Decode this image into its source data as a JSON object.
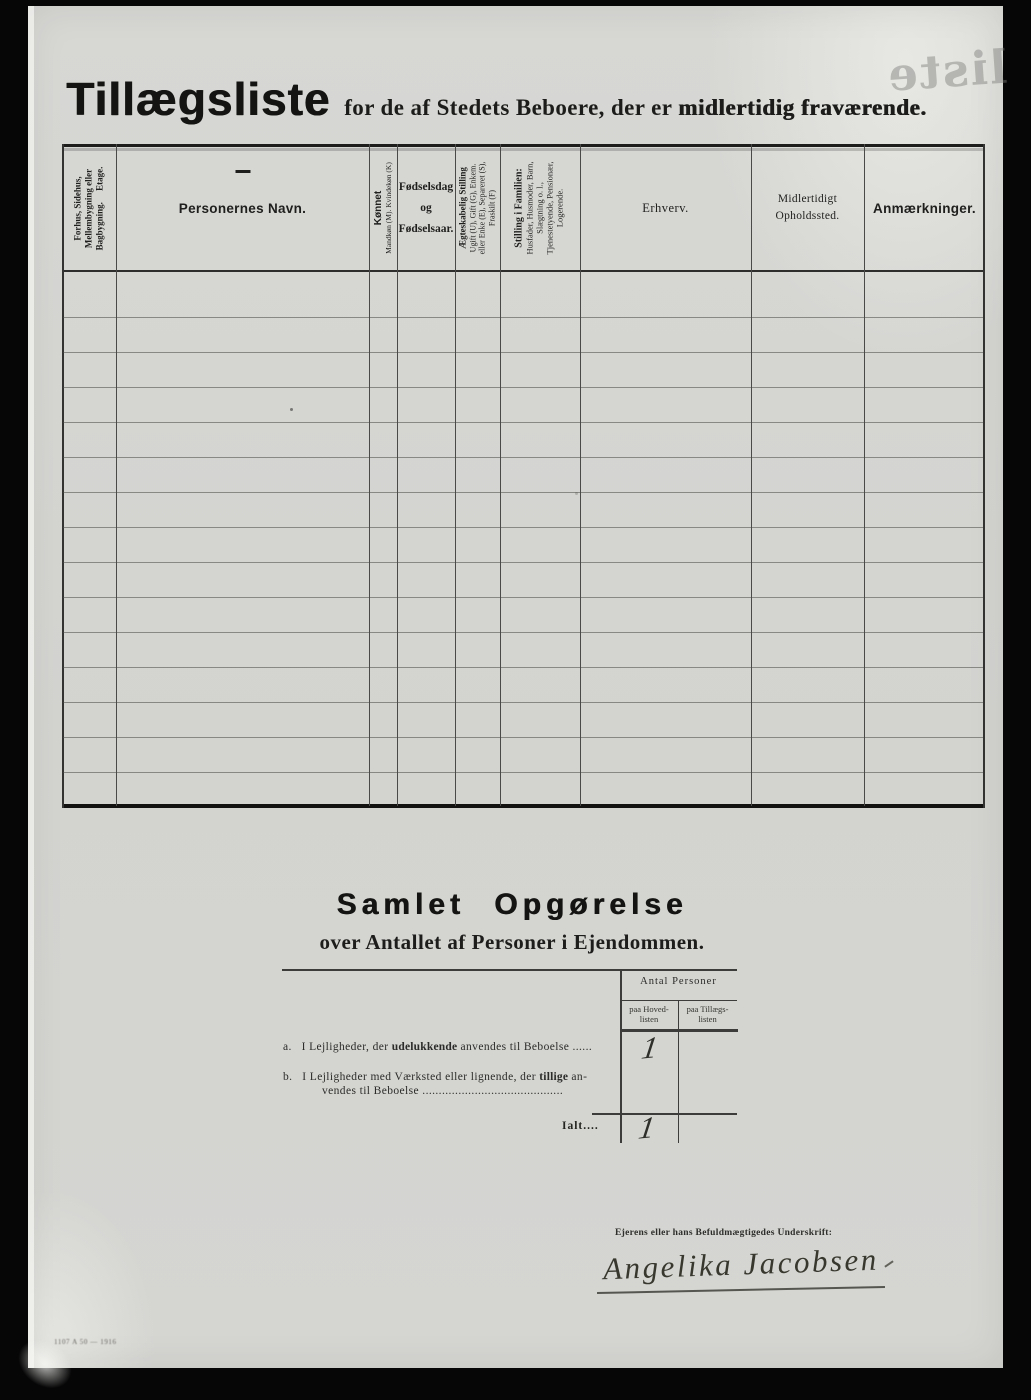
{
  "page": {
    "title": "Tillægsliste",
    "subtitle_regular": "for de af Stedets Beboere, der er",
    "subtitle_bold": "midlertidig fraværende.",
    "showthrough_text": "liste",
    "printer_mark": "1107 A 50 — 1916",
    "paper_color": "#d5d5d2",
    "ink_color": "#1d1d1b"
  },
  "table": {
    "row_count": 15,
    "columns": [
      {
        "id": "bygning",
        "lines": [
          "Forhus, Sidehus,",
          "Mellembygning eller",
          "Bagbygning.  Etage."
        ]
      },
      {
        "id": "navn",
        "title": "Personernes Navn."
      },
      {
        "id": "kon",
        "title": "Kønnet",
        "sub": "Mandkøn (M). Kvindekøn (K)"
      },
      {
        "id": "fodsel",
        "lines": [
          "Fødselsdag",
          "og",
          "Fødselsaar."
        ]
      },
      {
        "id": "aegteskab",
        "title": "Ægteskabelig Stilling",
        "sub_lines": [
          "Ugift (U), Gift (G), Enkem.",
          "eller Enke (E), Separeret (S),",
          "Fraskilt (F)"
        ]
      },
      {
        "id": "stilling",
        "title": "Stilling i Familien:",
        "sub_lines": [
          "Husfader, Husmoder, Barn,",
          "Slægtning o. l.,",
          "Tjenestetyende, Pensionær,",
          "Logerende."
        ]
      },
      {
        "id": "erhverv",
        "title": "Erhverv."
      },
      {
        "id": "ophold",
        "lines": [
          "Midlertidigt",
          "Opholdssted."
        ]
      },
      {
        "id": "anm",
        "title": "Anmærkninger."
      }
    ]
  },
  "summary": {
    "heading": "Samlet Opgørelse",
    "subheading": "over Antallet af Personer i Ejendommen.",
    "antal_header": "Antal Personer",
    "col_hoved_lines": [
      "paa Hoved-",
      "listen"
    ],
    "col_tillaegs_lines": [
      "paa Tillægs-",
      "listen"
    ],
    "row_a": {
      "label": "a.",
      "text_pre": "I Lejligheder, der ",
      "text_bold": "udelukkende",
      "text_post": " anvendes til Beboelse ......",
      "value_hovedlisten": "1"
    },
    "row_b": {
      "label": "b.",
      "text_pre": "I Lejligheder med Værksted eller lignende, der ",
      "text_bold": "tillige",
      "text_post": " an-",
      "text_line2": "vendes til Beboelse ..........................................."
    },
    "total": {
      "label": "Ialt....",
      "value_hovedlisten": "1"
    }
  },
  "signature": {
    "label": "Ejerens eller hans Befuldmægtigedes Underskrift:",
    "name": "Angelika Jacobsen"
  }
}
